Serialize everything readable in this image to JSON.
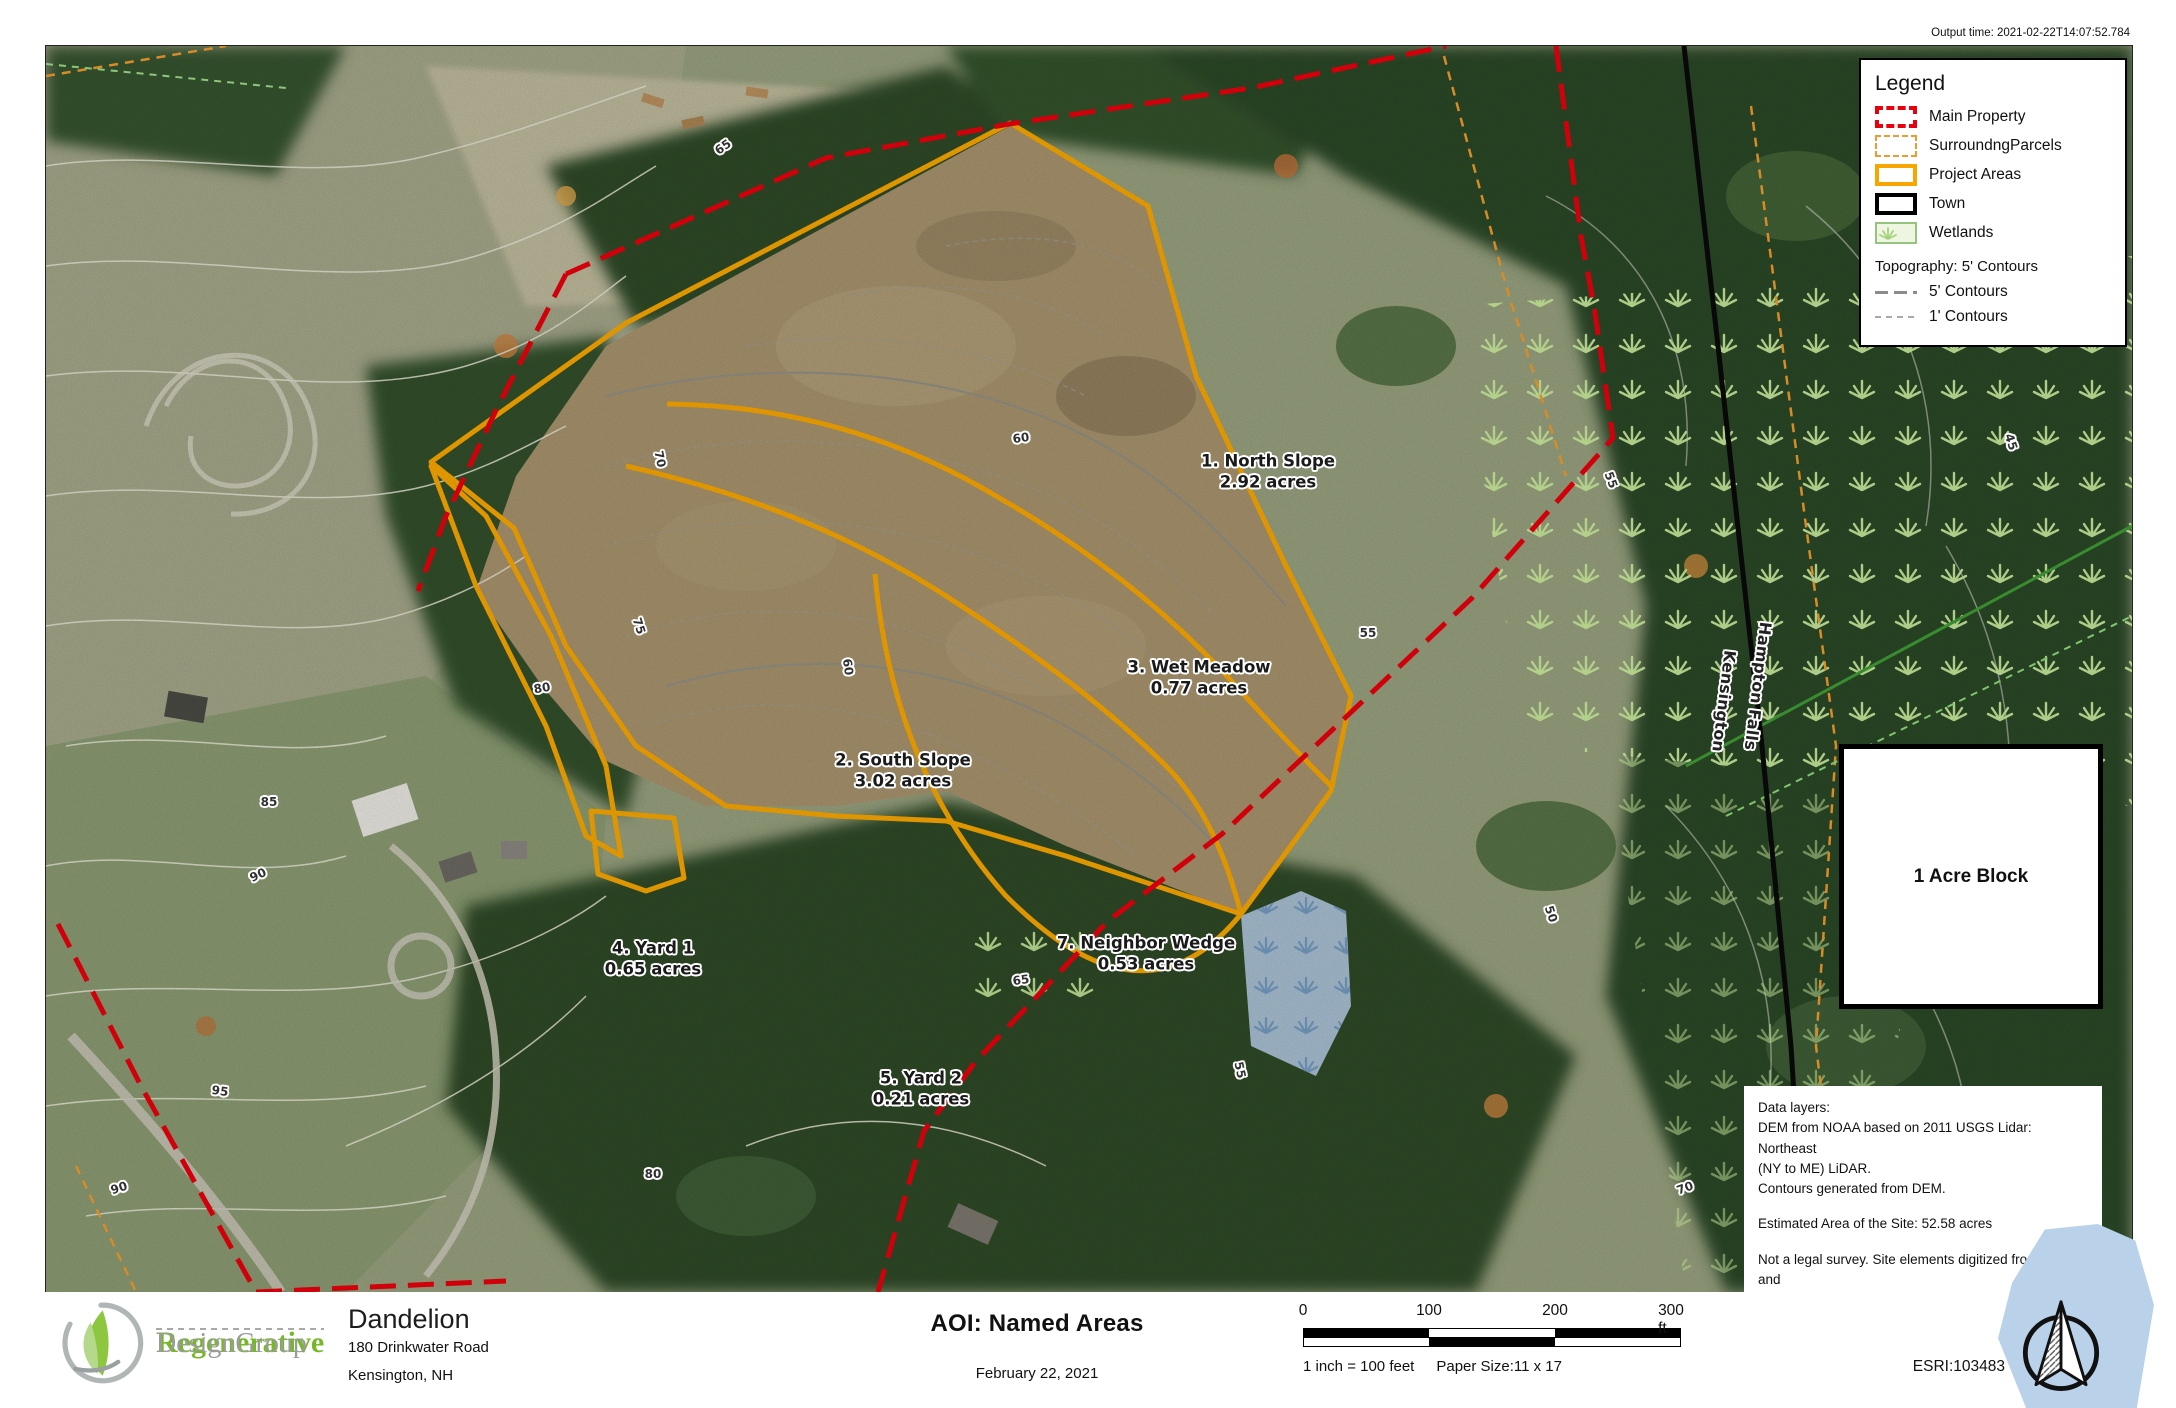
{
  "header": {
    "output_time": "Output time: 2021-02-22T14:07:52.784"
  },
  "legend": {
    "title": "Legend",
    "items": [
      {
        "label": "Main Property"
      },
      {
        "label": "SurroundngParcels"
      },
      {
        "label": "Project Areas"
      },
      {
        "label": "Town"
      },
      {
        "label": "Wetlands"
      }
    ],
    "topo_title": "Topography: 5' Contours",
    "topo_items": [
      {
        "label": "5' Contours"
      },
      {
        "label": "1' Contours"
      }
    ]
  },
  "map": {
    "areas": [
      {
        "name": "1. North Slope",
        "size": "2.92 acres"
      },
      {
        "name": "2. South Slope",
        "size": "3.02 acres"
      },
      {
        "name": "3. Wet Meadow",
        "size": "0.77 acres"
      },
      {
        "name": "4. Yard 1",
        "size": "0.65 acres"
      },
      {
        "name": "5. Yard 2",
        "size": "0.21 acres"
      },
      {
        "name": "7. Neighbor Wedge",
        "size": "0.53 acres"
      }
    ],
    "roads": {
      "road1": "Hampton Falls",
      "road2": "Kensington"
    },
    "acre_block": "1 Acre Block",
    "contours": [
      "65",
      "70",
      "75",
      "80",
      "85",
      "90",
      "95",
      "90",
      "80",
      "60",
      "60",
      "55",
      "50",
      "65",
      "55",
      "70",
      "45",
      "55"
    ]
  },
  "notes": {
    "line1": "Data layers:",
    "line2": "DEM from NOAA based on 2011 USGS Lidar: Northeast",
    "line3": "(NY to ME) LiDAR.",
    "line4": "Contours generated from DEM.",
    "line5": "Estimated Area of the Site: 52.58 acres",
    "line6": "Not a legal survey. Site elements digitized from DEM and",
    "line7": "Ortho and may not be accurate."
  },
  "footer": {
    "logo_name_1": "Regenerative",
    "logo_name_2": "DesignGroup",
    "project": "Dandelion",
    "address1": "180 Drinkwater Road",
    "address2": "Kensington, NH",
    "title": "AOI: Named Areas",
    "date": "February 22, 2021",
    "scale": {
      "t0": "0",
      "t1": "100",
      "t2": "200",
      "t3": "300 ft"
    },
    "scale_note": "1 inch = 100 feet",
    "paper_note": "Paper Size:11 x 17",
    "esri": "ESRI:103483"
  },
  "colors": {
    "main_property": "#e8000d",
    "surrounding_parcels": "#ef9b2d",
    "project_areas": "#f7a600",
    "town": "#000000",
    "wetlands_fill": "#eef6e2",
    "water": "#b9d2ea",
    "logo_green": "#76b82a",
    "logo_gray": "#9b9b9b"
  }
}
